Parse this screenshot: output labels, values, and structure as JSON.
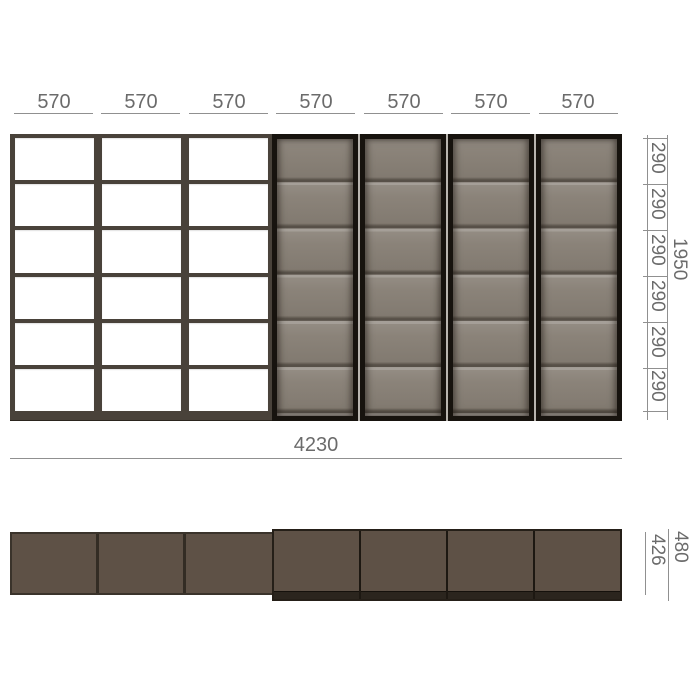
{
  "drawing": {
    "front_view": {
      "column_labels": [
        "570",
        "570",
        "570",
        "570",
        "570",
        "570",
        "570"
      ],
      "row_labels": [
        "290",
        "290",
        "290",
        "290",
        "290",
        "290"
      ],
      "height_label": "1950",
      "width_label": "4230",
      "open_shelf_columns": 3,
      "glass_door_columns": 4,
      "shelf_rows": 6
    },
    "top_view": {
      "overall_depth_label": "480",
      "open_shelf_depth_label": "426"
    },
    "colors": {
      "shelf_frame": "#49423a",
      "glass": "#877f75",
      "door_frame": "#17130e",
      "plan_body": "#5e5146",
      "dim_text": "#6b6b6b",
      "dim_line": "#909090",
      "background": "#ffffff"
    }
  }
}
